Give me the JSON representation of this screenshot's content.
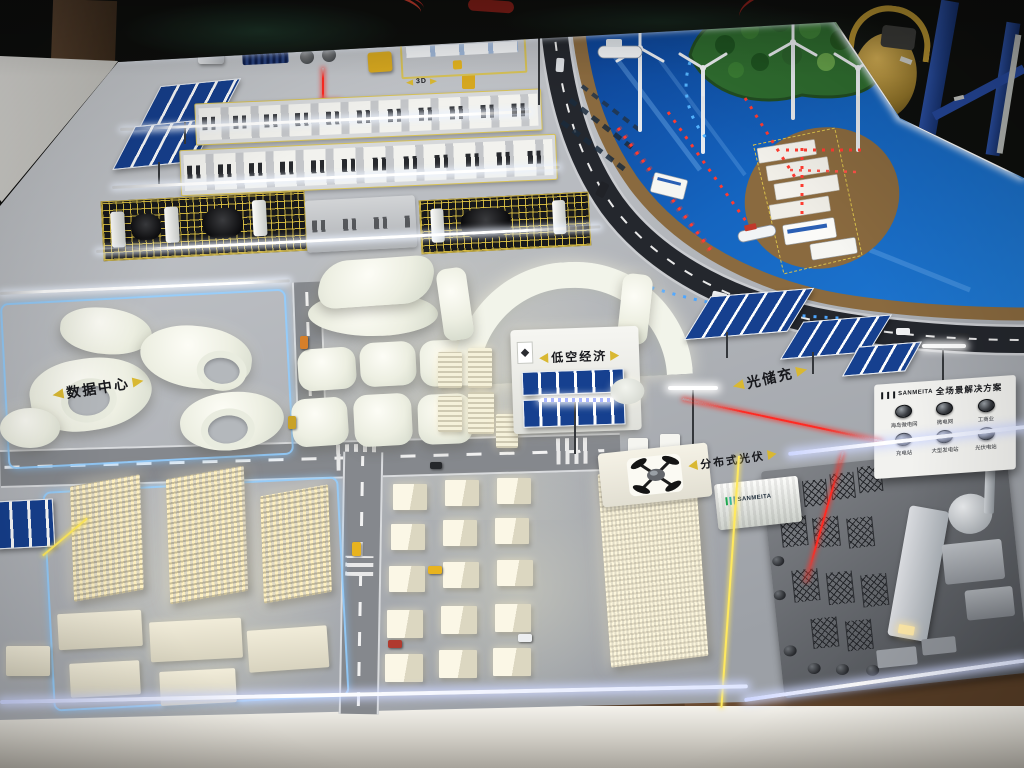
{
  "scene": {
    "title": "智慧能源园区沙盘模型照片",
    "labels": {
      "data_center": "数据中心",
      "solar_storage_charging": "光储充",
      "low_altitude_economy": "低空经济",
      "distributed_pv": "分布式光伏",
      "logistics_3d": "3D"
    },
    "sign_board": {
      "brand": "SANMEITA",
      "title": "全场景解决方案",
      "scenarios": [
        {
          "label": "海岛微电网"
        },
        {
          "label": "微电网"
        },
        {
          "label": "工商业"
        },
        {
          "label": "充电站"
        },
        {
          "label": "大型发电站"
        },
        {
          "label": "光伏电站"
        }
      ]
    },
    "container_brand": "SANMEITA",
    "colors": {
      "board_gray": "#b5b8bd",
      "water_blue": "#1565c0",
      "accent_yellow": "#d9b832",
      "neon_blue": "#91cdff",
      "led_white": "#ffffff",
      "led_red": "#ff2a22",
      "warm_glow": "#ffe9a8"
    }
  }
}
